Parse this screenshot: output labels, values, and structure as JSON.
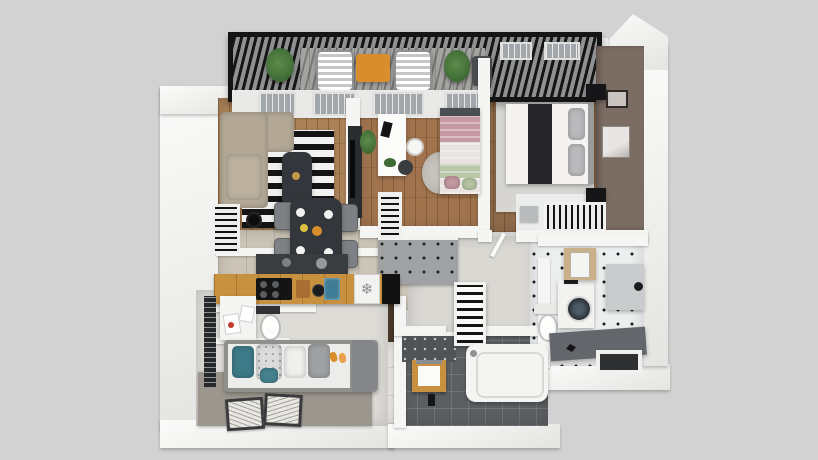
{
  "palette": {
    "bg": "#d2d2d2",
    "wall_white": "#f5f5f3",
    "taupe_wall": "#7b6d63",
    "pergola_dark": "#161616",
    "deck_gray": "#a3a3a1",
    "wood_living": "#ab8258",
    "wood_study": "#a1744e",
    "wood_master": "#8f6b4a",
    "wood_dark": "#4a3829",
    "counter_wood": "#c8913f",
    "tile_beige": "#ccc5b7",
    "tile_light": "#e6e4df",
    "tile_dark": "#5c5f62",
    "tile_bath_white": "#eceeef",
    "corridor_gray": "#dad8d3",
    "rug_kids": "#9c978e",
    "rug_master": "#d6d5d2",
    "rug_round": "#b9b6b0",
    "sofa_beige": "#b3a795",
    "charcoal": "#33373b",
    "chair_gray": "#7d8084",
    "teal": "#3d7a88",
    "pink": "#c59aa2",
    "mint": "#b8c7a6",
    "plant_green": "#3e6b35",
    "orange": "#d98e2b",
    "drum_dark": "#26282c",
    "boiler_tan": "#c9b089",
    "bench_gray": "#63666a",
    "kids_base": "#dedcd7"
  },
  "icons": {
    "fridge_snowflake": "❄"
  },
  "rooms": [
    {
      "id": "balcony",
      "items": [
        "pergola-roof",
        "lounge-chair",
        "lounge-chair",
        "outdoor-table",
        "plant",
        "plant",
        "side-chair"
      ]
    },
    {
      "id": "living-room",
      "items": [
        "corner-sofa",
        "striped-rug",
        "coffee-table",
        "floor-lamp",
        "tv-unit",
        "radiator-shelf"
      ]
    },
    {
      "id": "dining-area",
      "items": [
        "dining-table",
        "chair",
        "chair",
        "chair",
        "chair",
        "plates"
      ]
    },
    {
      "id": "kitchen",
      "items": [
        "counter",
        "cooktop",
        "cutting-board",
        "fridge",
        "oven",
        "upper-cabinets"
      ]
    },
    {
      "id": "study-bedroom",
      "items": [
        "desk",
        "desk-chair",
        "round-table",
        "single-bed",
        "round-rug",
        "striped-wardrobe",
        "plant"
      ]
    },
    {
      "id": "master-bedroom",
      "items": [
        "double-bed",
        "nightstand",
        "nightstand",
        "area-rug",
        "accent-wall",
        "wall-art",
        "wardrobe"
      ]
    },
    {
      "id": "bathroom-right",
      "items": [
        "toilet",
        "washing-machine",
        "boiler",
        "shower-bench",
        "mirror-cabinet",
        "wall-niche"
      ]
    },
    {
      "id": "bathroom-main",
      "items": [
        "bathtub",
        "vanity-mirror",
        "towel-ladder",
        "dark-tile-wall"
      ]
    },
    {
      "id": "wc",
      "items": [
        "washbasin-cabinet",
        "toilet",
        "window-blinds"
      ]
    },
    {
      "id": "kids-room",
      "items": [
        "sofa-bed",
        "pillows",
        "rug",
        "picture-frame",
        "picture-frame"
      ]
    },
    {
      "id": "hallway",
      "items": [
        "beige-tiles",
        "dark-wood-floor",
        "entry-tiles",
        "slippers"
      ]
    }
  ]
}
